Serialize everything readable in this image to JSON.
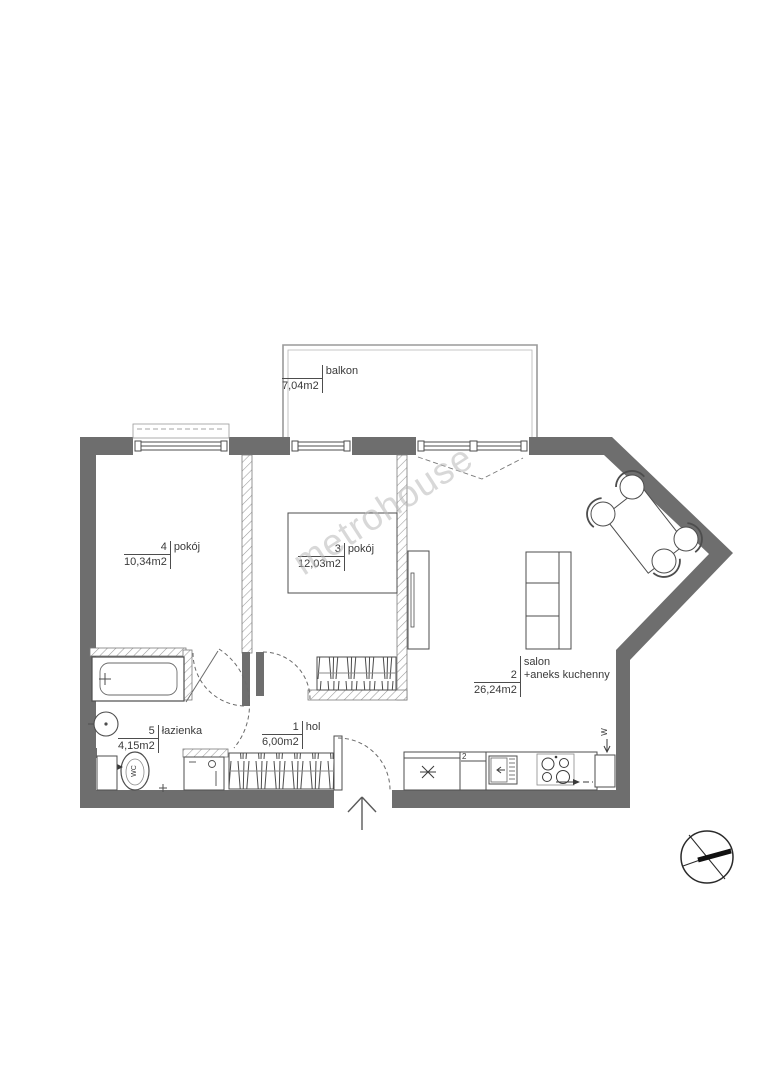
{
  "watermark": "metrohouse",
  "rooms": {
    "balkon": {
      "number": "",
      "name": "balkon",
      "area": "7,04m2"
    },
    "room4": {
      "number": "4",
      "name": "pokój",
      "area": "10,34m2"
    },
    "room3": {
      "number": "3",
      "name": "pokój",
      "area": "12,03m2"
    },
    "salon": {
      "title": "salon",
      "number": "2",
      "name": "+aneks kuchenny",
      "area": "26,24m2"
    },
    "lazienka": {
      "number": "5",
      "name": "łazienka",
      "area": "4,15m2"
    },
    "hol": {
      "number": "1",
      "name": "hol",
      "area": "6,00m2"
    }
  },
  "annotations": {
    "kitchen_cabinet_number": "2",
    "vent_symbol": "W",
    "wc_label": "WC"
  },
  "colors": {
    "wall": "#6e6e6e",
    "line": "#4d4d4d",
    "watermark": "#b9b9b9",
    "background": "#ffffff"
  }
}
